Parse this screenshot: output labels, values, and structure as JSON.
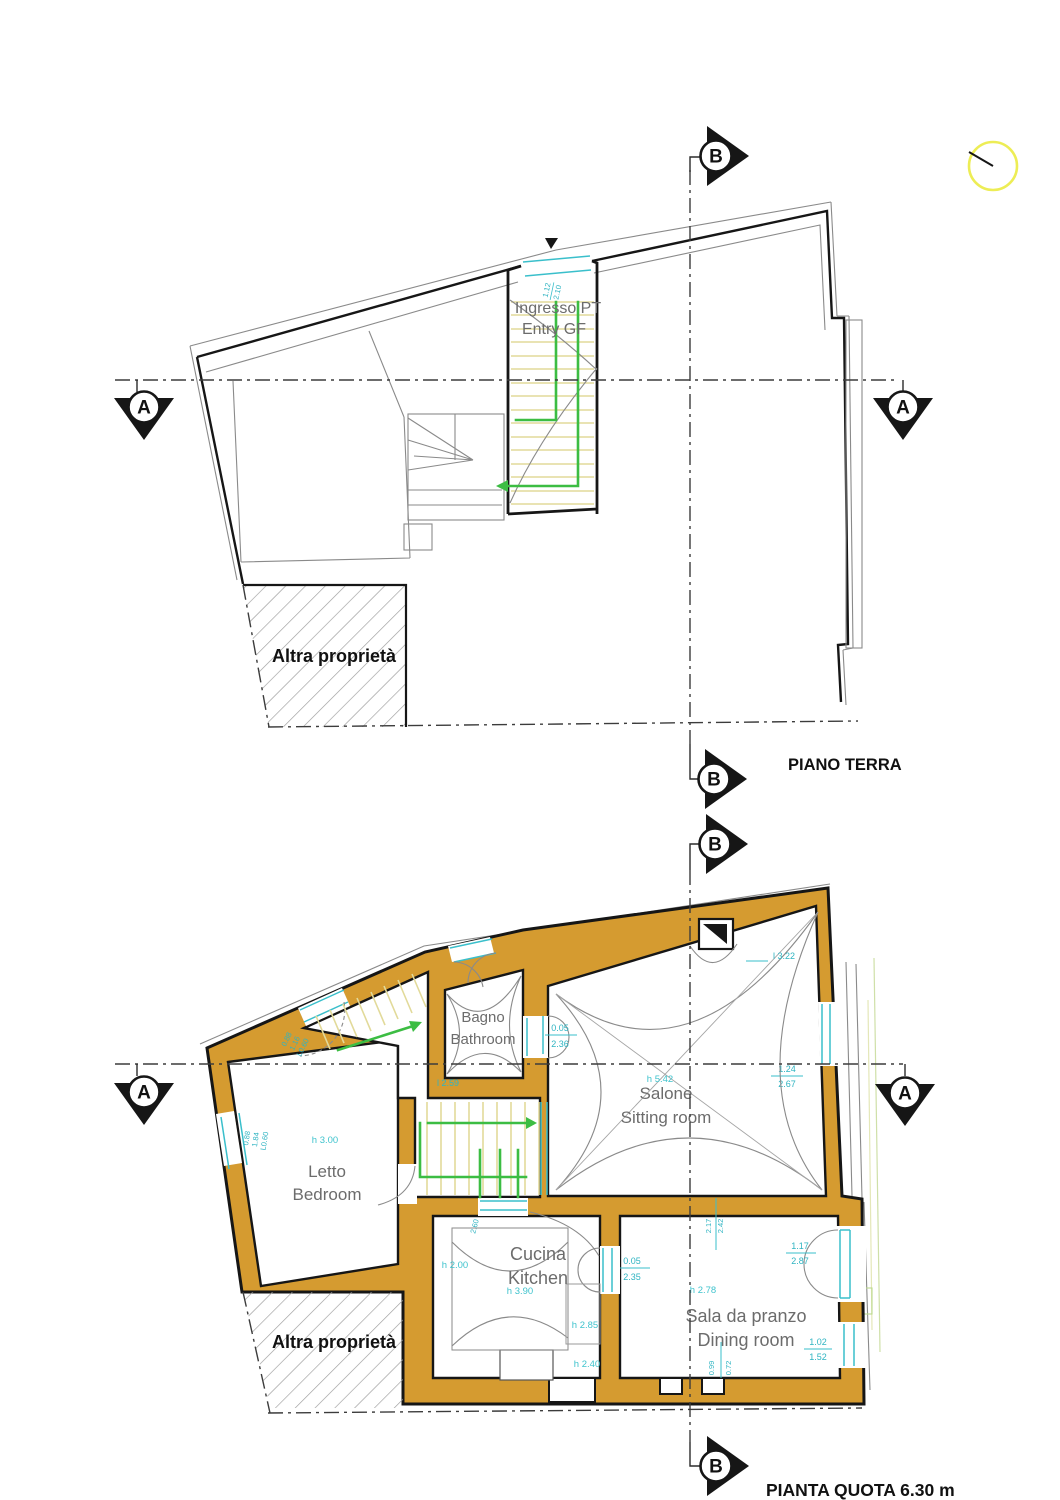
{
  "colors": {
    "wall_fill": "#d59b30",
    "dimension_cyan": "#3abfcb",
    "route_green": "#3cbd43",
    "tread_yellow": "#e2da9a",
    "hatch_gray": "#9b9b9b",
    "compass_yellow": "#eded55"
  },
  "markers": {
    "section_a": "A",
    "section_b": "B"
  },
  "upper_plan": {
    "title": "PIANO TERRA",
    "entry_label_line1": "Ingresso PT",
    "entry_label_line2": "Entry GF",
    "other_property_label": "Altra proprietà",
    "entry_door_dim": {
      "a": "1.12",
      "b": "2.10"
    }
  },
  "lower_plan": {
    "title": "PIANTA QUOTA 6.30 m",
    "other_property_label": "Altra proprietà",
    "rooms": {
      "bagno": {
        "name_it": "Bagno",
        "name_en": "Bathroom"
      },
      "salone": {
        "name_it": "Salone",
        "name_en": "Sitting room",
        "height": "h 5.42"
      },
      "letto": {
        "name_it": "Letto",
        "name_en": "Bedroom",
        "height": "h 3.00"
      },
      "cucina": {
        "name_it": "Cucina",
        "name_en": "Kitchen",
        "height": "h 3.90"
      },
      "pranzo": {
        "name_it": "Sala da pranzo",
        "name_en": "Dining room",
        "height": "h 2.78"
      }
    },
    "dims": {
      "salone_top": "l 3.22",
      "salone_window_w": "1.24",
      "salone_window_h": "2.67",
      "bagno_door_w": "0.05",
      "bagno_door_h": "2.36",
      "bagno_width": "l 2.59",
      "letto_window_a": "0.88",
      "letto_window_b": "1.84",
      "letto_window_c": "L0.60",
      "letto_door_a": "0.88",
      "letto_door_b": "1.16",
      "letto_door_c": "L0.60",
      "cucina_left_h": "h 2.00",
      "cucina_nook_h": "h 2.85",
      "cucina_low_h": "h 2.40",
      "cucina_door_w": "0.05",
      "cucina_door_h": "2.35",
      "stair_door": "2.60",
      "pranzo_window_w": "1.17",
      "pranzo_window_h": "2.87",
      "pranzo_side_w": "1.02",
      "pranzo_side_h": "1.52",
      "pranzo_top_a": "2.17",
      "pranzo_top_b": "2.42",
      "pranzo_bottom_a": "0.99",
      "pranzo_bottom_b": "0.72"
    }
  }
}
